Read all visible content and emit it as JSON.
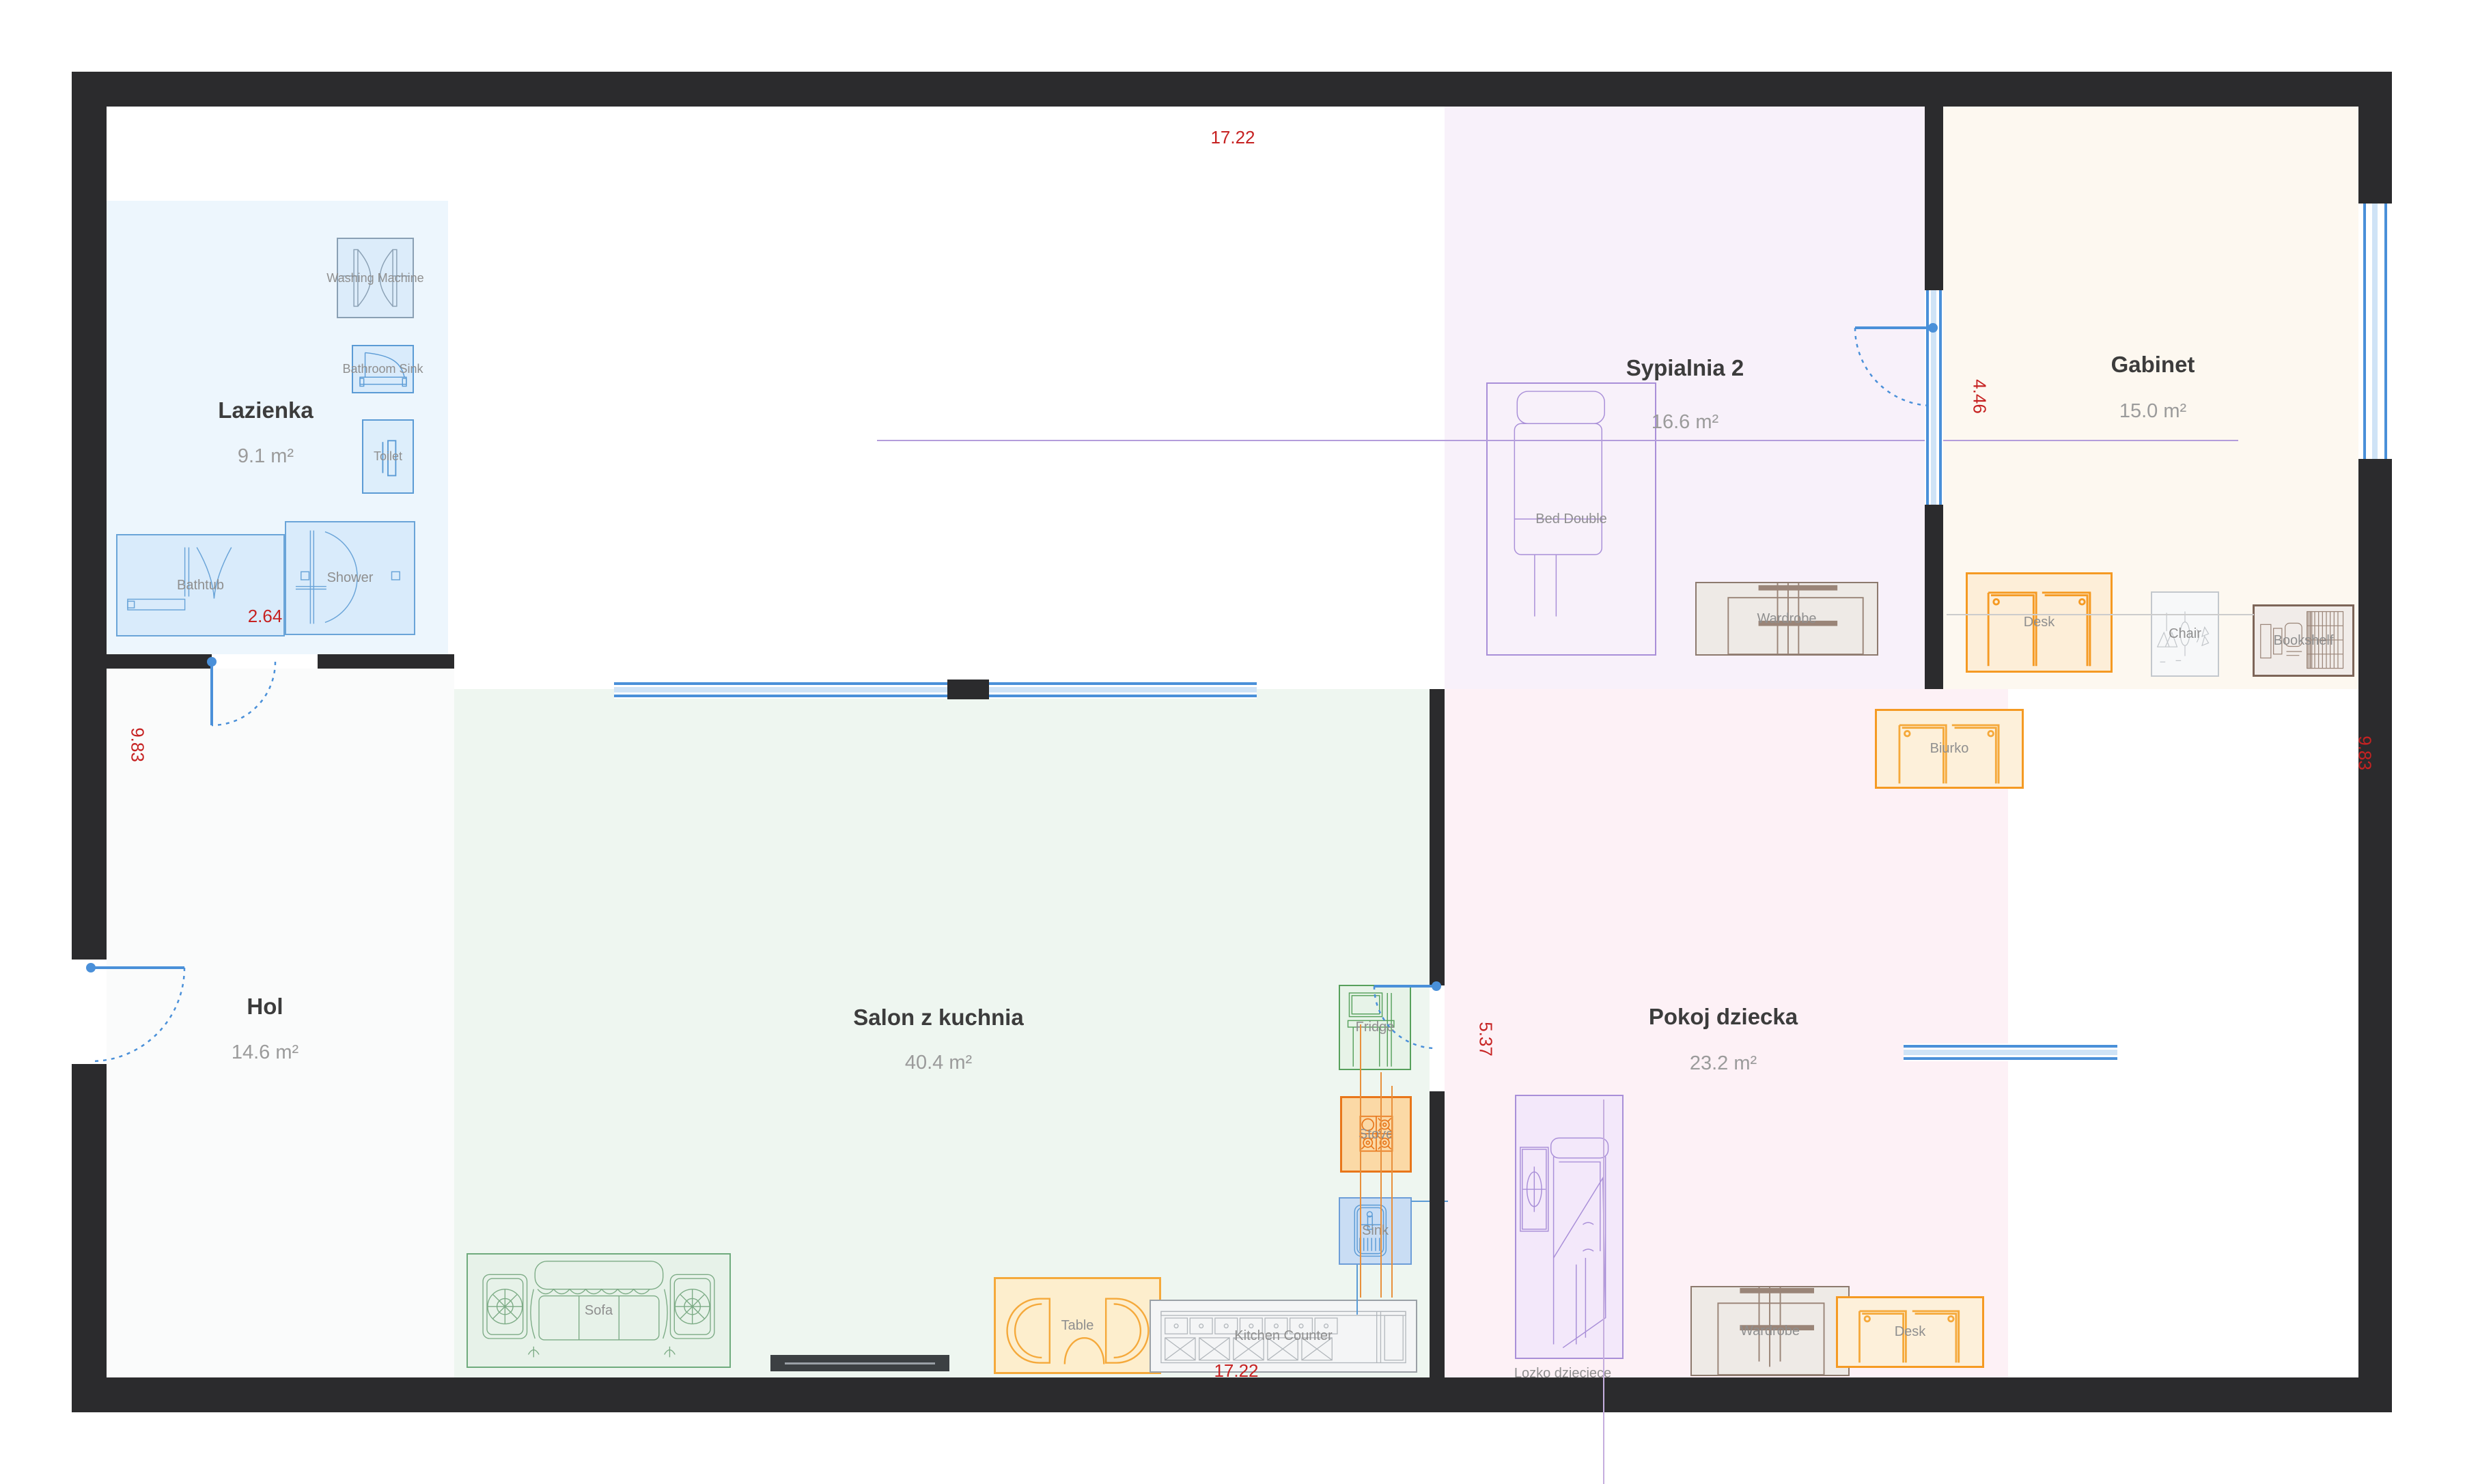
{
  "app": {
    "type": "floor-plan-editor"
  },
  "rooms": [
    {
      "id": "lazienka",
      "name": "Lazienka",
      "area": "9.1 m²"
    },
    {
      "id": "sypialnia2",
      "name": "Sypialnia 2",
      "area": "16.6 m²"
    },
    {
      "id": "gabinet",
      "name": "Gabinet",
      "area": "15.0 m²"
    },
    {
      "id": "hol",
      "name": "Hol",
      "area": "14.6 m²"
    },
    {
      "id": "salon",
      "name": "Salon z kuchnia",
      "area": "40.4 m²"
    },
    {
      "id": "pokoj",
      "name": "Pokoj dziecka",
      "area": "23.2 m²"
    }
  ],
  "furniture": {
    "washing_machine": "Washing Machine",
    "bathroom_sink": "Bathroom Sink",
    "toilet": "Toilet",
    "bathtub": "Bathtub",
    "shower": "Shower",
    "bed_double": "Bed Double",
    "wardrobe_sypialnia": "Wardrobe",
    "desk_gabinet": "Desk",
    "chair": "Chair",
    "bookshelf": "Bookshelf",
    "biurko": "Biurko",
    "lozko_dzieciece": "Lozko dzieciece",
    "wardrobe_pokoj": "Wardrobe",
    "desk_pokoj": "Desk",
    "sofa": "Sofa",
    "table": "Table",
    "kitchen_counter": "Kitchen Counter",
    "fridge": "Fridge",
    "stove": "Stove",
    "sink": "Sink"
  },
  "dimensions": {
    "top": "17.22",
    "bottom": "17.22",
    "left": "9.83",
    "right": "9.83",
    "sypialnia_wall": "4.46",
    "pokoj_wall": "5.37",
    "lazienka_inner": "2.64"
  },
  "colors": {
    "wall": "#2b2b2d",
    "door": "#4a90d9",
    "dimension": "#c62222",
    "room_lazienka": "#edf6fd",
    "room_sypialnia": "#f8f1fa",
    "room_gabinet": "#fdf8f0",
    "room_hol": "#fafbfb",
    "room_salon": "#eef6f0",
    "room_pokoj": "#fdf1f6"
  }
}
